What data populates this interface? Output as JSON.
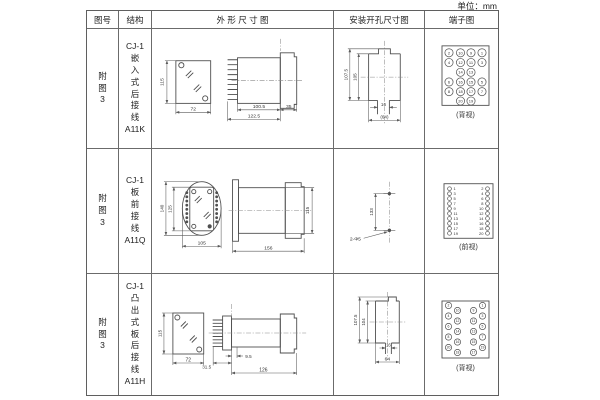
{
  "unit_label": "单位：mm",
  "headers": {
    "fig_no": "图号",
    "structure": "结构",
    "outline": "外 形 尺 寸 图",
    "install": "安装开孔尺寸图",
    "terminal": "端子图"
  },
  "rows": [
    {
      "fig_no": [
        "附",
        "图",
        "3"
      ],
      "structure": [
        "CJ-1",
        "嵌",
        "入",
        "式",
        "后",
        "接",
        "线",
        "A11K"
      ],
      "outline_dims": {
        "front_h": "115",
        "front_w": "72",
        "body_len": "100.5",
        "total_len": "122.5",
        "flange_w": "35"
      },
      "install_dims": {
        "outer_h": "107.5",
        "inner_h": "105",
        "slot_w": "16",
        "base_w": "(64)"
      },
      "terminal": {
        "caption": "(背视)",
        "layout": "grid",
        "rows": [
          [
            "2",
            "10",
            "9",
            "1"
          ],
          [
            "4",
            "12",
            "11",
            "3"
          ],
          [
            "14",
            "13"
          ],
          [
            "6",
            "16",
            "15",
            "5"
          ],
          [
            "8",
            "18",
            "17",
            "7"
          ],
          [
            "20",
            "19"
          ]
        ]
      }
    },
    {
      "fig_no": [
        "附",
        "图",
        "3"
      ],
      "structure": [
        "CJ-1",
        "板",
        "前",
        "接",
        "线",
        "A11Q"
      ],
      "outline_dims": {
        "outer_h": "140",
        "inner_h": "125",
        "front_w": "105",
        "body_len": "156",
        "side_h": "115"
      },
      "install_dims": {
        "hole_dist": "133",
        "holes_label": "2-Φ5"
      },
      "terminal": {
        "caption": "(前视)",
        "layout": "columns",
        "left": [
          "1",
          "3",
          "5",
          "7",
          "9",
          "11",
          "13",
          "15",
          "17",
          "19"
        ],
        "right": [
          "2",
          "4",
          "6",
          "8",
          "10",
          "12",
          "14",
          "16",
          "18",
          "20"
        ]
      }
    },
    {
      "fig_no": [
        "附",
        "图",
        "3"
      ],
      "structure": [
        "CJ-1",
        "凸",
        "出",
        "式",
        "板",
        "后",
        "接",
        "线",
        "A11H"
      ],
      "outline_dims": {
        "front_h": "115",
        "front_w": "72",
        "pin_gap": "9.5",
        "plate_w": "31.5",
        "total_len": "126"
      },
      "install_dims": {
        "outer_h": "107.5",
        "inner_h": "104",
        "slot_w": "16",
        "base_w": "64"
      },
      "terminal": {
        "caption": "(背视)",
        "layout": "staggered",
        "left_outer": [
          "2",
          "4",
          "6",
          "8",
          "20"
        ],
        "left_inner": [
          "10",
          "12",
          "14",
          "16",
          "18"
        ],
        "right_inner": [
          "9",
          "11",
          "13",
          "15",
          "17"
        ],
        "right_outer": [
          "1",
          "3",
          "5",
          "7",
          "19"
        ]
      }
    }
  ]
}
